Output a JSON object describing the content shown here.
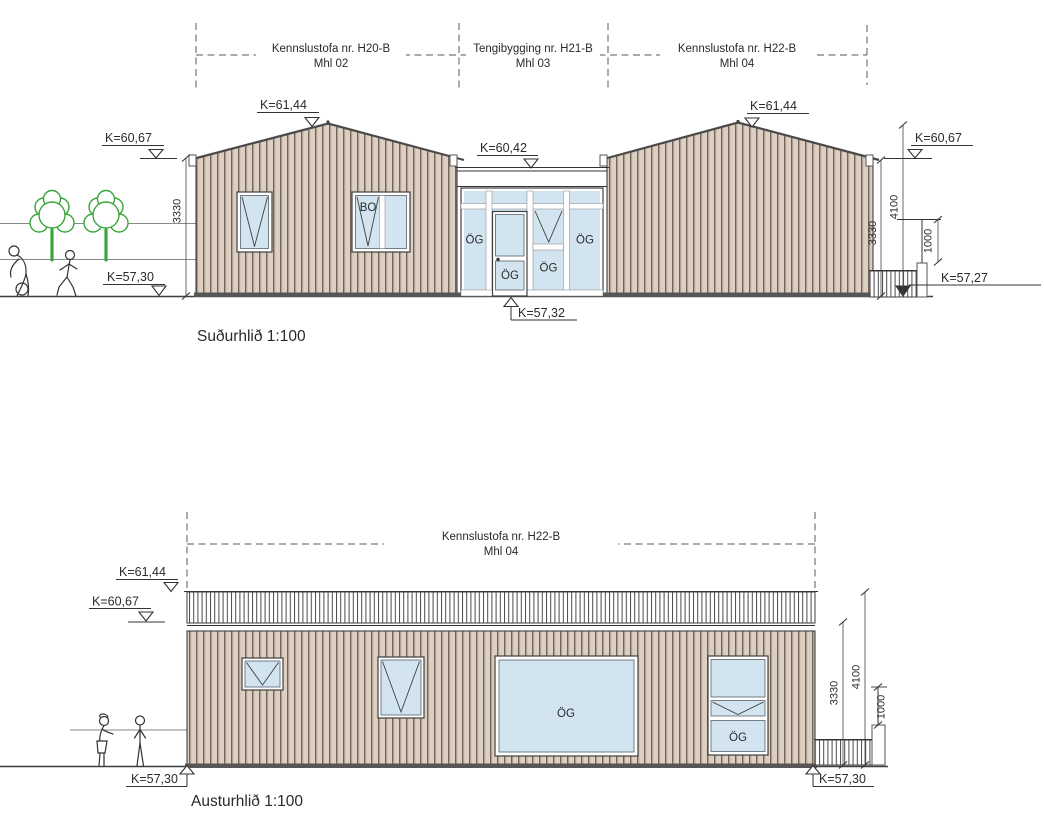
{
  "south": {
    "title": "Suðurhlið 1:100",
    "sections": [
      {
        "name": "Kennslustofa nr. H20-B",
        "mhl": "Mhl 02"
      },
      {
        "name": "Tengibygging nr. H21-B",
        "mhl": "Mhl 03"
      },
      {
        "name": "Kennslustofa nr. H22-B",
        "mhl": "Mhl 04"
      }
    ],
    "levels": {
      "peak_left": "K=61,44",
      "eave_left": "K=60,67",
      "ground_left": "K=57,30",
      "connector_top": "K=60,42",
      "connector_ground": "K=57,32",
      "peak_right": "K=61,44",
      "eave_right": "K=60,67",
      "ground_right": "K=57,27"
    },
    "dims": {
      "wall_left": "3330",
      "wall_right": "3330",
      "total_right": "4100",
      "railing": "1000"
    },
    "labels": {
      "bo": "BO",
      "og_left_panel": "ÖG",
      "og_door": "ÖG",
      "og_mid": "ÖG",
      "og_right_panel": "ÖG"
    }
  },
  "east": {
    "title": "Austurhlið 1:100",
    "sections": [
      {
        "name": "Kennslustofa nr. H22-B",
        "mhl": "Mhl 04"
      }
    ],
    "levels": {
      "parapet": "K=61,44",
      "eave": "K=60,67",
      "ground_left": "K=57,30",
      "ground_right": "K=57,30"
    },
    "dims": {
      "wall": "3330",
      "total": "4100",
      "railing": "1000"
    },
    "labels": {
      "og_large": "ÖG",
      "og_small": "ÖG"
    }
  },
  "colors": {
    "glass": "#d2e4f0",
    "clad": "#ddcfc1",
    "cladline": "#6f655b",
    "tree": "#3aa63a"
  }
}
